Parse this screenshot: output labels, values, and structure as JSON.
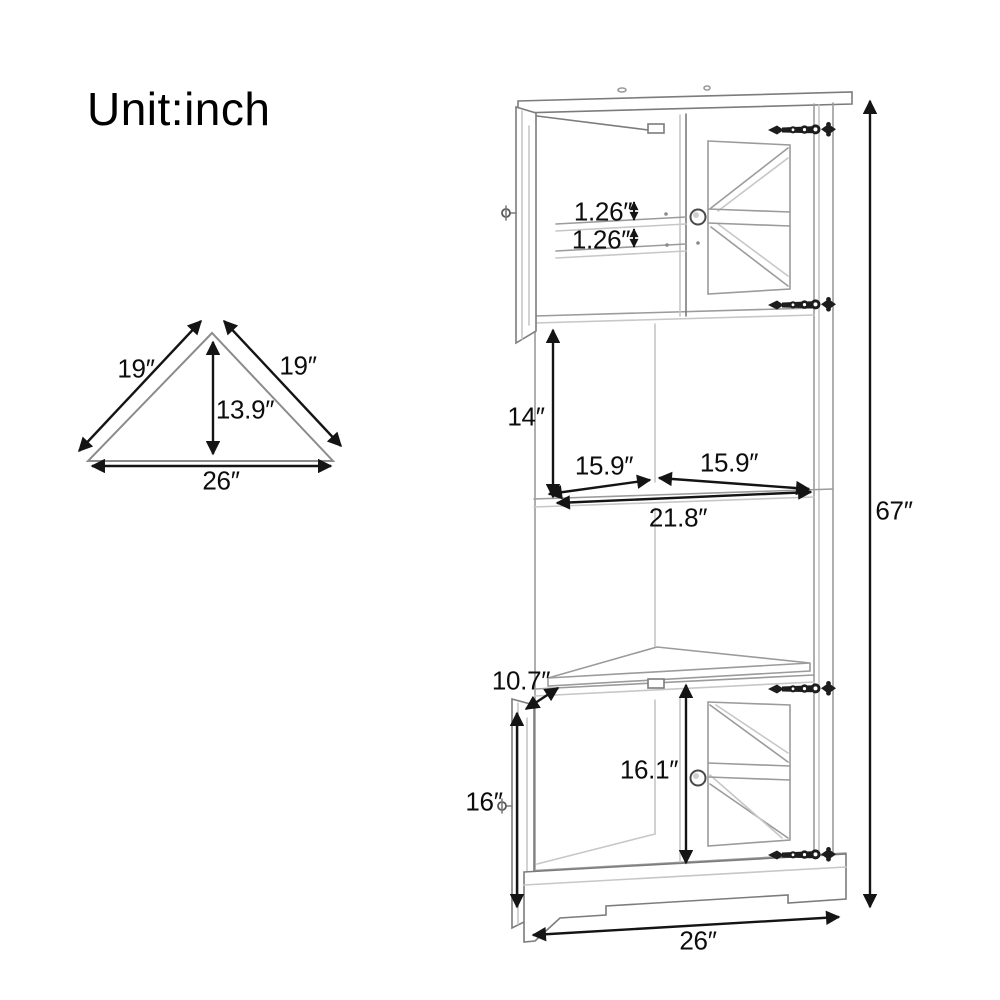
{
  "title": "Unit:inch",
  "colors": {
    "background": "#ffffff",
    "cabinet_line": "#9b9b9b",
    "dimension_line": "#141414",
    "hinge": "#1d1d1d"
  },
  "triangle": {
    "left_side": "19″",
    "right_side": "19″",
    "depth": "13.9″",
    "width": "26″"
  },
  "cabinet": {
    "overall_height": "67″",
    "upper_shelf_thickness": "1.26″",
    "lower_shelf_thickness": "1.26″",
    "open_section_height": "14″",
    "shelf_left_width": "15.9″",
    "shelf_right_width": "15.9″",
    "shelf_full_width": "21.8″",
    "door_width": "10.7″",
    "lower_door_height": "16″",
    "lower_opening_height": "16.1″",
    "base_width": "26″"
  }
}
